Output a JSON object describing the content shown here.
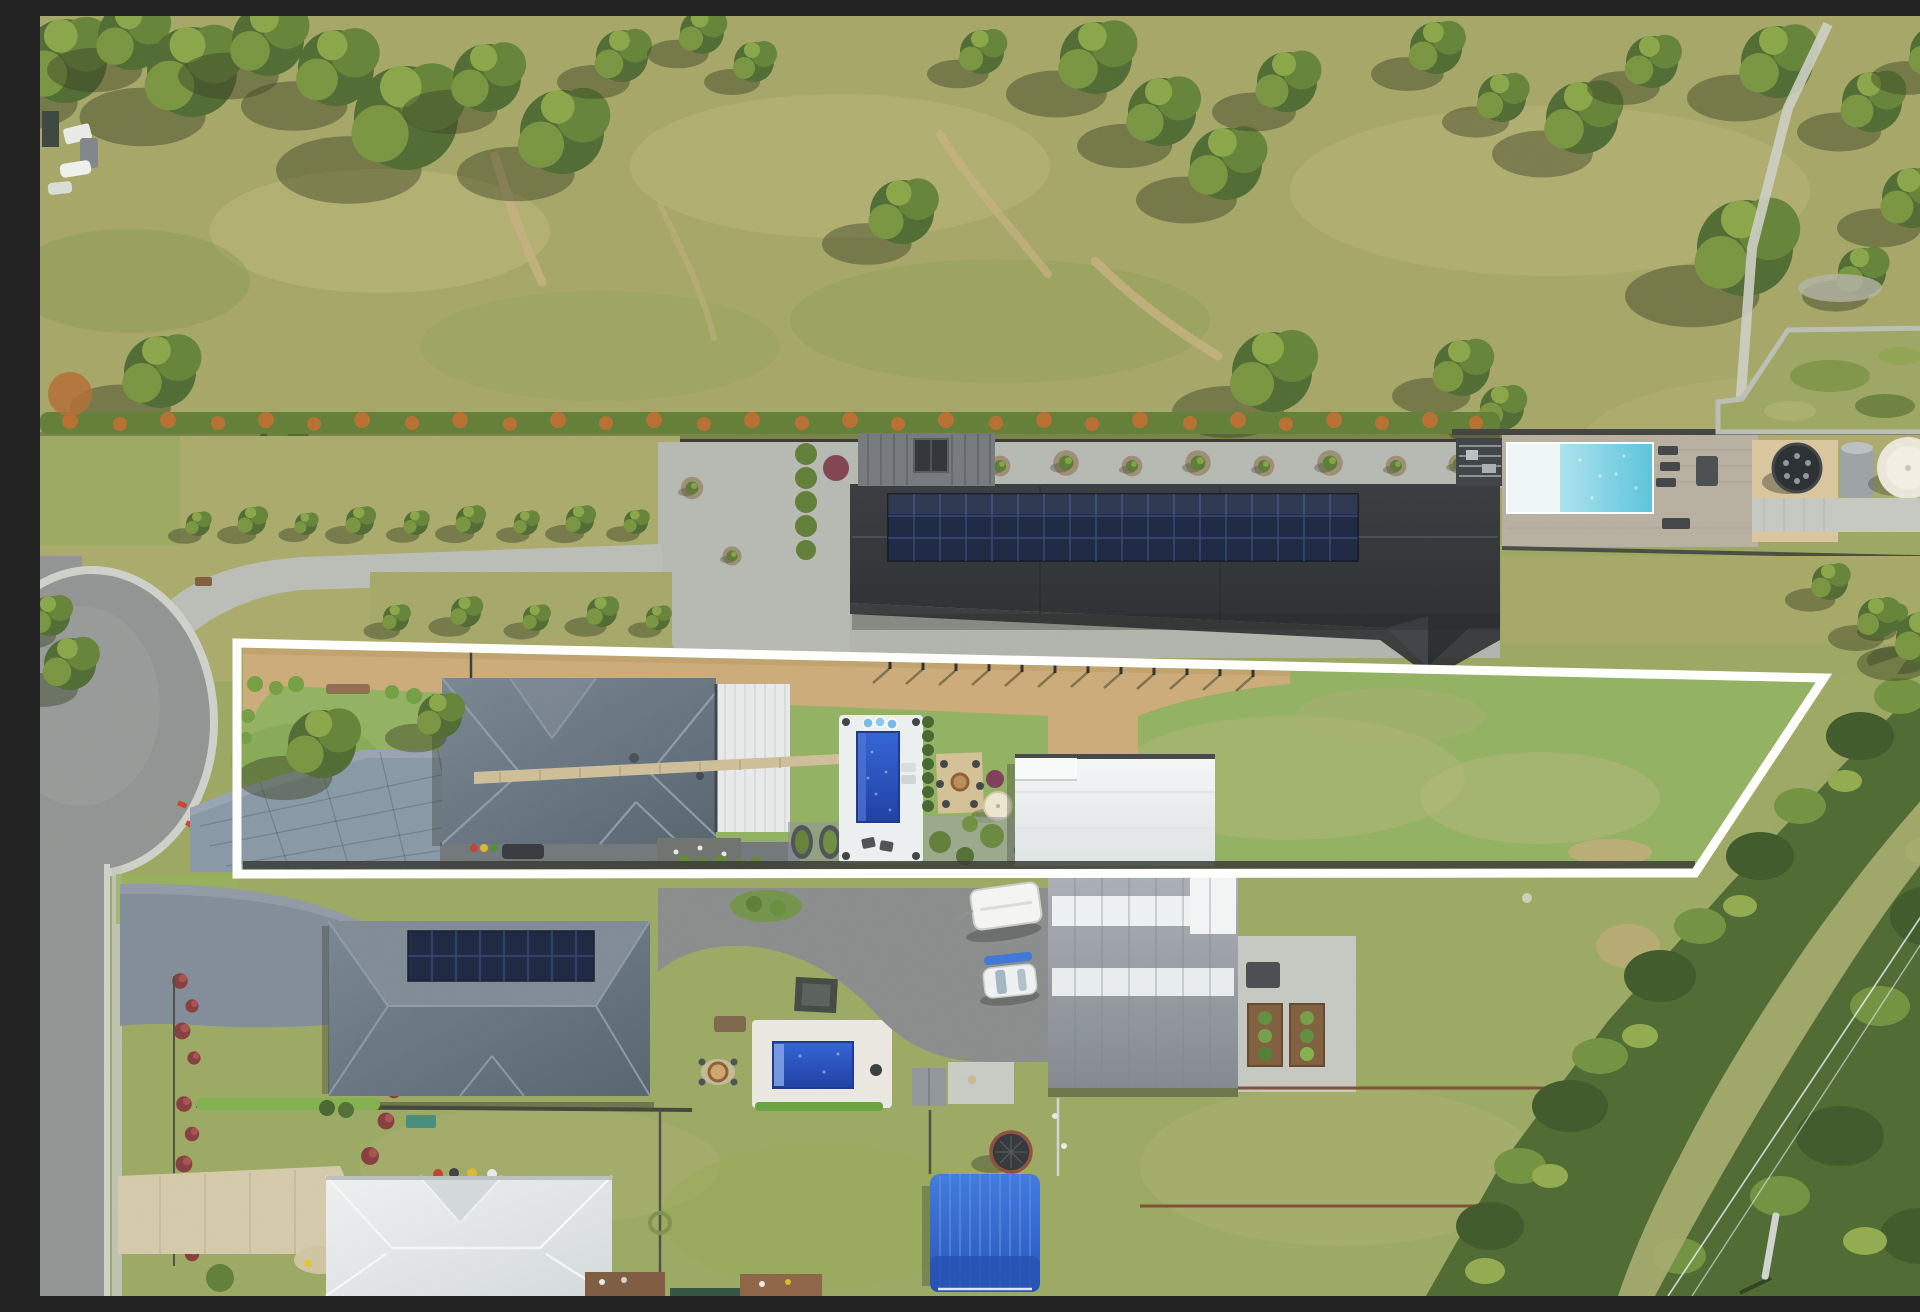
{
  "meta": {
    "type": "aerial-drone-photograph",
    "description": "Top-down aerial drone photo of a semi-rural residential allotment outlined with a white property boundary. Inside the boundary: a grey hip-roof house with white garage roof, bluestone paver driveway, tan dirt driveway, rectangular dark-blue swimming pool with white paving, fire-pit area, cream umbrella, large white shed and a big lawn. North of the boundary: a long black shed/house with rooftop solar panels, gravel courtyard with shrubs, aqua lap pool with timber deck, pergola, round hot tub and cream water tank, orange-tipped hedge row and open grassy paddock with gum trees. South: neighbouring houses with grey and white roofs, solar panels, royal-blue pool, caravan, white car, large grey shed with skylights, blue-roofed canopy, trampoline, cul-de-sac road at left and native bushland with power lines at lower right.",
    "no_visible_text": true
  },
  "scene": {
    "boundary_overlay": {
      "label": "white property boundary outline",
      "vertices": [
        [
          197,
          627
        ],
        [
          1784,
          662
        ],
        [
          1655,
          857
        ],
        [
          197,
          858
        ]
      ],
      "stroke_width": 9
    },
    "features": [
      "grassy paddock with gum trees and dirt tracks",
      "parked trailers and machinery at far left",
      "orange-tipped hedge row",
      "long black shed with solar panel array",
      "gravel courtyard with circular garden beds",
      "aqua lap pool with white ledge, timber deck and pergola",
      "round dark hot tub and cream water tank",
      "fenced garden plot and footpath at top right",
      "subject lot: tan dirt driveway with young fence posts",
      "subject lot: bluestone paver driveway from cul-de-sac",
      "subject lot: grey hip-roof house with white garage roof",
      "subject lot: dark-blue pool on white paving with spa",
      "subject lot: fire-pit square, cream umbrella, garden beds",
      "subject lot: large white shed",
      "subject lot: open lawn",
      "cul-de-sac road and street heading south",
      "neighbour house with rooftop solar and royal-blue pool",
      "caravan, white car, blue kayak, big grey shed with skylights",
      "veggie garden beds on concrete pad",
      "white hip-roof neighbour house with beige footpath",
      "blue ribbed canopy structure and trampoline",
      "bushland band with power lines and pole at lower right"
    ]
  },
  "colors": {
    "boundary_line": "#ffffff",
    "paddock_grass": "#a2a363",
    "lawn_green": "#8fae5e",
    "lawn_olive": "#99a65f",
    "tree_canopy": "#4c672f",
    "bushland": "#4a652e",
    "hedge_green": "#5e7a33",
    "hedge_orange": "#c06a2c",
    "concrete": "#b4b7b0",
    "asphalt_road": "#8e9090",
    "bluestone_drive": "#8594a3",
    "dirt_drive_tan": "#c9a875",
    "dark_roof": "#2a2d31",
    "solar_panel": "#17223f",
    "subject_roof_gray": "#637181",
    "garage_white": "#e8eaeb",
    "shed_white": "#f0f2f3",
    "neighbor_roof_gray": "#6b7883",
    "neighbor_roof_white": "#e3e6e8",
    "big_shed_gray": "#9aa1a8",
    "pool_aqua": "#7fd2e4",
    "pool_blue": "#2350c8",
    "pool_blue_neighbor": "#2a5ad0",
    "blue_canopy": "#2f63d2",
    "deck_timber": "#b5ad9e",
    "sand_paving": "#d8c49c",
    "hot_tub_dark": "#26292c",
    "water_tank_cream": "#e9e4d8",
    "fence_dark": "#33352f",
    "fence_brown": "#7a4a30",
    "caravan_white": "#f4f5f3",
    "umbrella_cream": "#ece4d0"
  }
}
